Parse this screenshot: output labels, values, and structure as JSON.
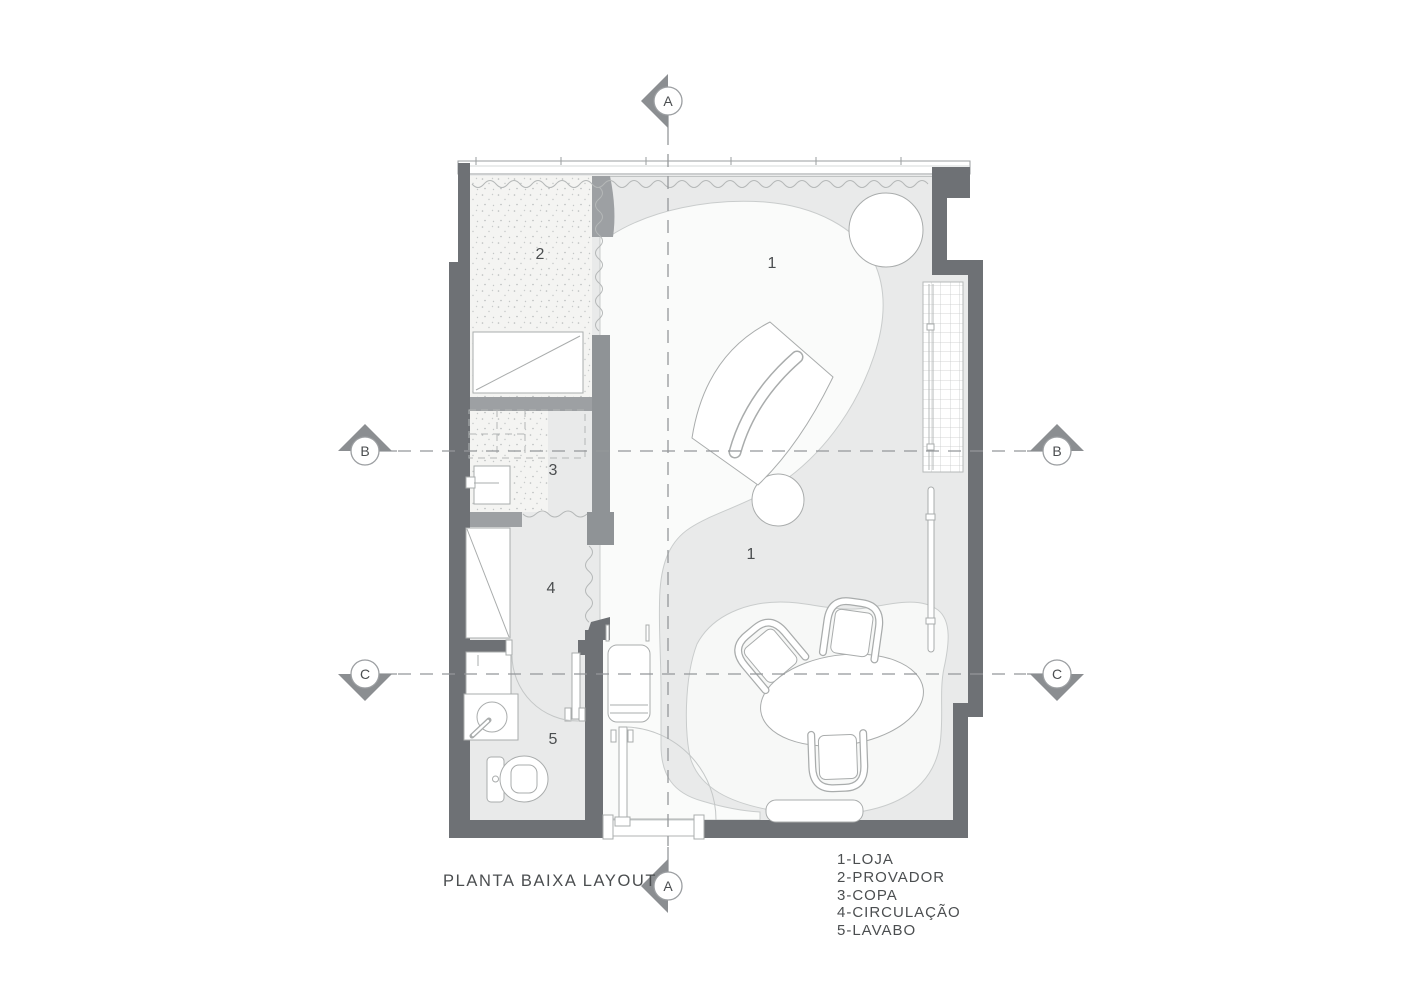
{
  "title": "PLANTA BAIXA LAYOUT",
  "legend": {
    "items": [
      "1-LOJA",
      "2-PROVADOR",
      "3-COPA",
      "4-CIRCULAÇÃO",
      "5-LAVABO"
    ]
  },
  "rooms": {
    "loja_top": "1",
    "loja_bottom": "1",
    "provador": "2",
    "copa": "3",
    "circulacao": "4",
    "lavabo": "5"
  },
  "section_markers": {
    "a": "A",
    "b": "B",
    "c": "C"
  },
  "colors": {
    "outer_wall": "#6e7175",
    "partition_wall": "#9da0a3",
    "floor": "#e9eaea",
    "walkway": "#fafbfa",
    "outline": "#a9acac",
    "dash_line": "#94979a",
    "text": "#4b4e50"
  }
}
